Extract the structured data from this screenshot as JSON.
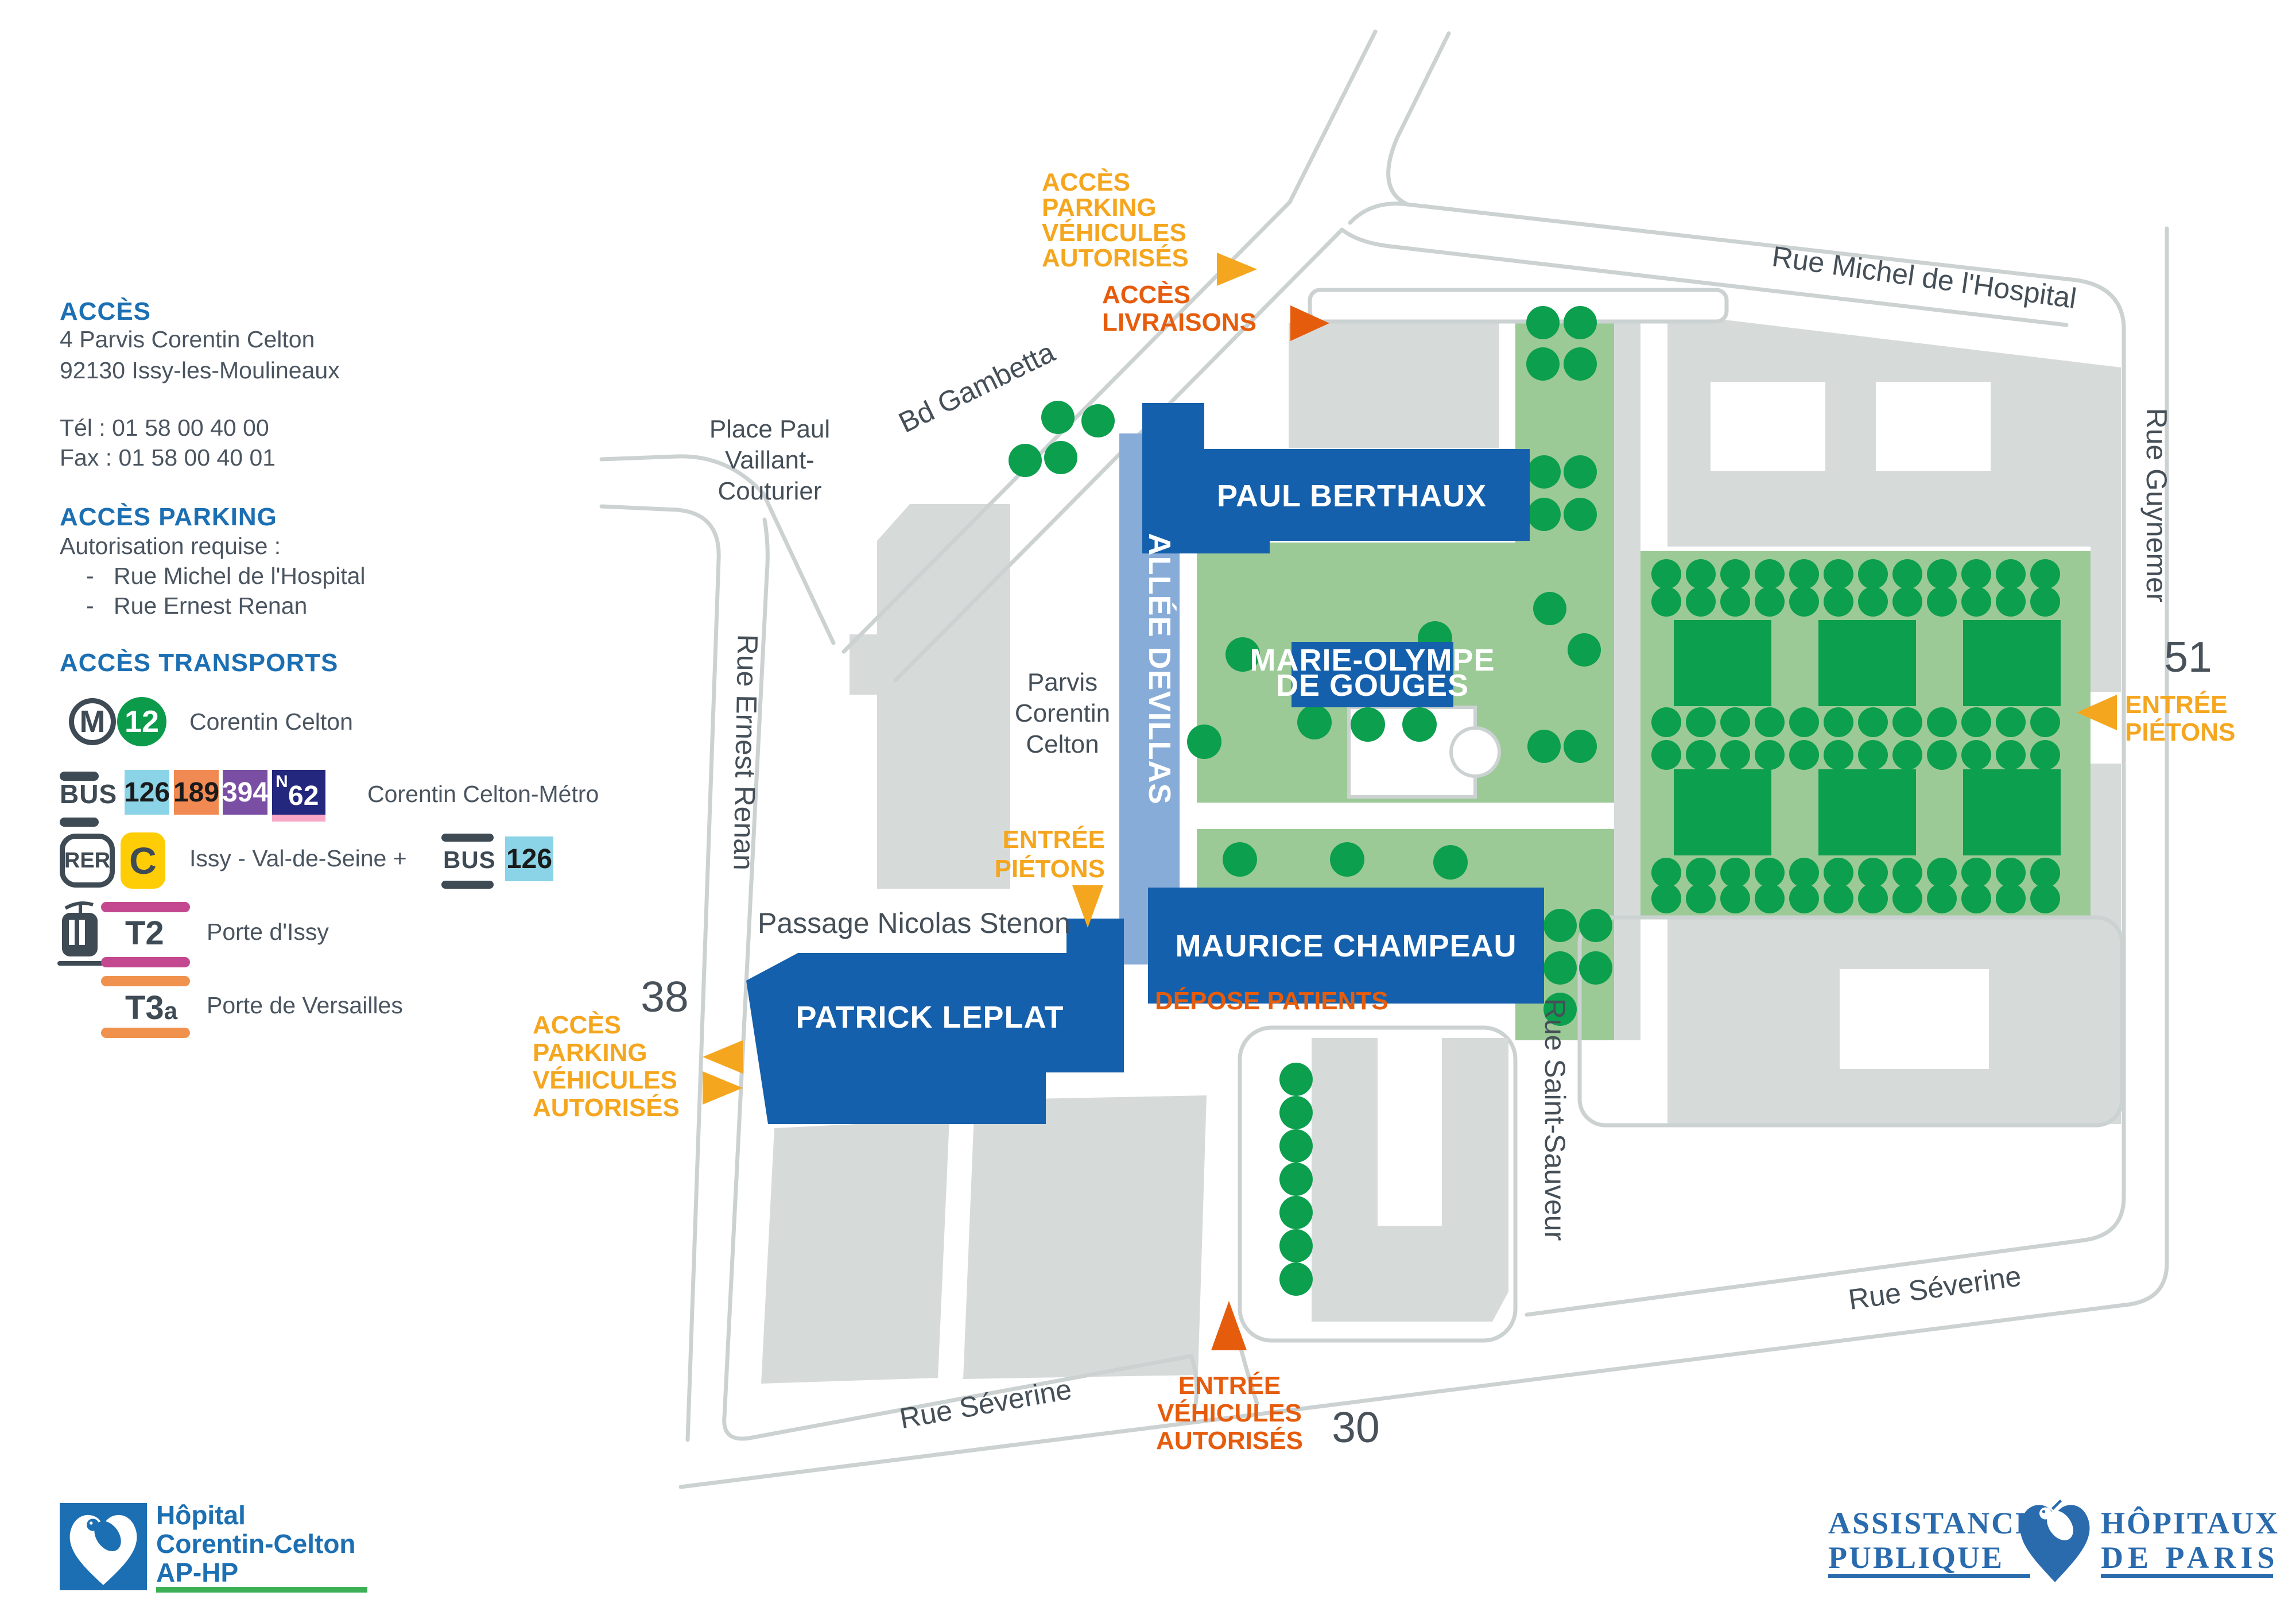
{
  "legend": {
    "acces_title": "ACCÈS",
    "address_line1": "4 Parvis Corentin Celton",
    "address_line2": "92130 Issy-les-Moulineaux",
    "tel": "Tél : 01 58 00 40 00",
    "fax": "Fax : 01 58 00 40 01",
    "parking_title": "ACCÈS PARKING",
    "parking_note": "Autorisation requise :",
    "parking_dash": "-",
    "parking_item1": "Rue Michel de l'Hospital",
    "parking_item2": "Rue Ernest Renan",
    "transports_title": "ACCÈS TRANSPORTS",
    "metro": {
      "m": "M",
      "line": "12",
      "station": "Corentin Celton"
    },
    "bus": {
      "label": "BUS",
      "line1": "126",
      "line2": "189",
      "line3": "394",
      "night_n": "N",
      "night_num": "62",
      "station": "Corentin Celton-Métro"
    },
    "rer": {
      "label": "RER",
      "line": "C",
      "station": "Issy - Val-de-Seine +",
      "bus_label": "BUS",
      "bus_line": "126"
    },
    "t2": {
      "line": "T2",
      "station": "Porte d'Issy"
    },
    "t3a": {
      "line": "T3",
      "suffix": "a",
      "station": "Porte de Versailles"
    }
  },
  "map": {
    "streets": {
      "michel": "Rue Michel de l'Hospital",
      "guynemer": "Rue Guynemer",
      "gambetta": "Bd Gambetta",
      "renan": "Rue Ernest Renan",
      "severine_left": "Rue Séverine",
      "severine_right": "Rue Séverine",
      "saint_sauveur": "Rue Saint-Sauveur",
      "passage": "Passage Nicolas Stenon"
    },
    "places": {
      "place_paul_l1": "Place Paul",
      "place_paul_l2": "Vaillant-",
      "place_paul_l3": "Couturier",
      "parvis_l1": "Parvis",
      "parvis_l2": "Corentin",
      "parvis_l3": "Celton"
    },
    "buildings": {
      "paul_berthaux": "PAUL BERTHAUX",
      "marie_olympe_l1": "MARIE-OLYMPE",
      "marie_olympe_l2": "DE GOUGES",
      "maurice_champeau": "MAURICE CHAMPEAU",
      "patrick_leplat": "PATRICK LEPLAT",
      "allee": "ALLÉE DEVILLAS"
    },
    "access": {
      "parking_top_l1": "ACCÈS",
      "parking_top_l2": "PARKING",
      "parking_top_l3": "VÉHICULES",
      "parking_top_l4": "AUTORISÉS",
      "livraisons_l1": "ACCÈS",
      "livraisons_l2": "LIVRAISONS",
      "pietons_right_l1": "ENTRÉE",
      "pietons_right_l2": "PIÉTONS",
      "pietons_center_l1": "ENTRÉE",
      "pietons_center_l2": "PIÉTONS",
      "parking_left_l1": "ACCÈS",
      "parking_left_l2": "PARKING",
      "parking_left_l3": "VÉHICULES",
      "parking_left_l4": "AUTORISÉS",
      "vehicules_l1": "ENTRÉE",
      "vehicules_l2": "VÉHICULES",
      "vehicules_l3": "AUTORISÉS",
      "depose": "DÉPOSE PATIENTS"
    },
    "numbers": {
      "n51": "51",
      "n38": "38",
      "n30": "30"
    }
  },
  "footer": {
    "left_logo": {
      "l1": "Hôpital",
      "l2": "Corentin-Celton",
      "l3": "AP-HP"
    },
    "right_logo": {
      "w1": "ASSISTANCE",
      "w2": "PUBLIQUE",
      "w3": "HÔPITAUX",
      "w4": "DE PARIS"
    }
  },
  "colors": {
    "heading_blue": "#1C6FB2",
    "building_blue": "#1560AC",
    "allee_blue": "#88ACD8",
    "light_green": "#9CCA96",
    "dark_green": "#0C9F4D",
    "yellow_access": "#F5A61F",
    "orange_access": "#E65C0D",
    "gray_building": "#D6DBDA",
    "gray_road": "#CBD2D1",
    "metro12_green": "#0B9B4B",
    "bus126_cyan": "#8BD3E6",
    "bus189_orange": "#F08A52",
    "bus394_purple": "#7A4FA3",
    "busN62_navy": "#23277E",
    "rerC_yellow": "#FFCD05",
    "t2_pink": "#C4488F",
    "t3a_orange": "#F0924E"
  }
}
